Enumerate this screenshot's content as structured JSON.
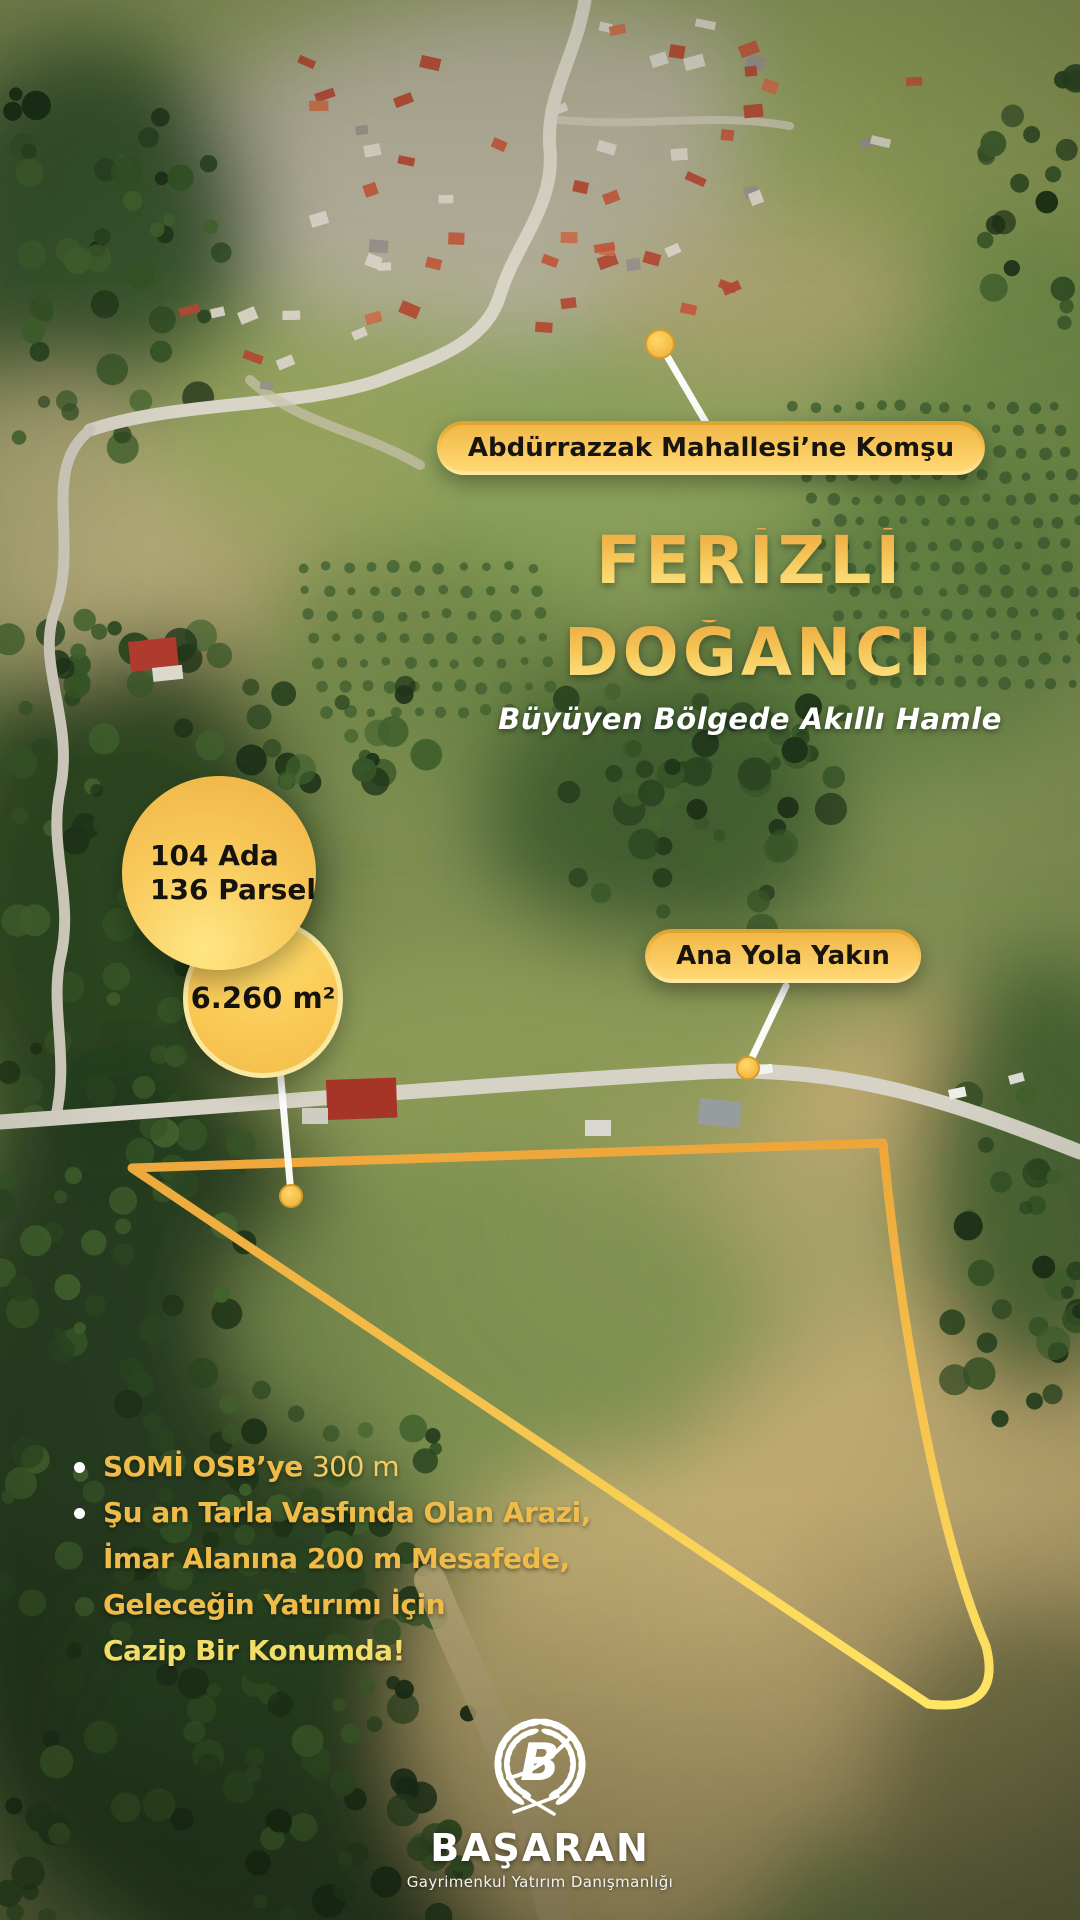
{
  "badges": {
    "neighborhood": "Abdürrazzak Mahallesi’ne Komşu",
    "road": "Ana Yola Yakın"
  },
  "title": {
    "line1": "FERİZLİ",
    "line2": "DOĞANCI",
    "subtitle": "Büyüyen Bölgede Akıllı Hamle"
  },
  "parcel": {
    "block": "104 Ada",
    "lot": "136 Parsel",
    "area": "6.260 m²"
  },
  "features": {
    "bullet1_bold": "SOMİ OSB’ye",
    "bullet1_value": "300 m",
    "bullet2_line1": "Şu an Tarla Vasfında Olan Arazi,",
    "bullet2_line2": "İmar Alanına 200 m Mesafede,",
    "bullet2_line3": "Geleceğin Yatırımı İçin",
    "bullet2_line4": "Cazip Bir Konumda!"
  },
  "brand": {
    "name": "BAŞARAN",
    "tagline": "Gayrimenkul Yatırım Danışmanlığı",
    "monogram": "B"
  },
  "colors": {
    "gold": "#F2B93F",
    "gold_light": "#FFE26A",
    "text_dark": "#171511",
    "white": "#FFFFFF"
  }
}
